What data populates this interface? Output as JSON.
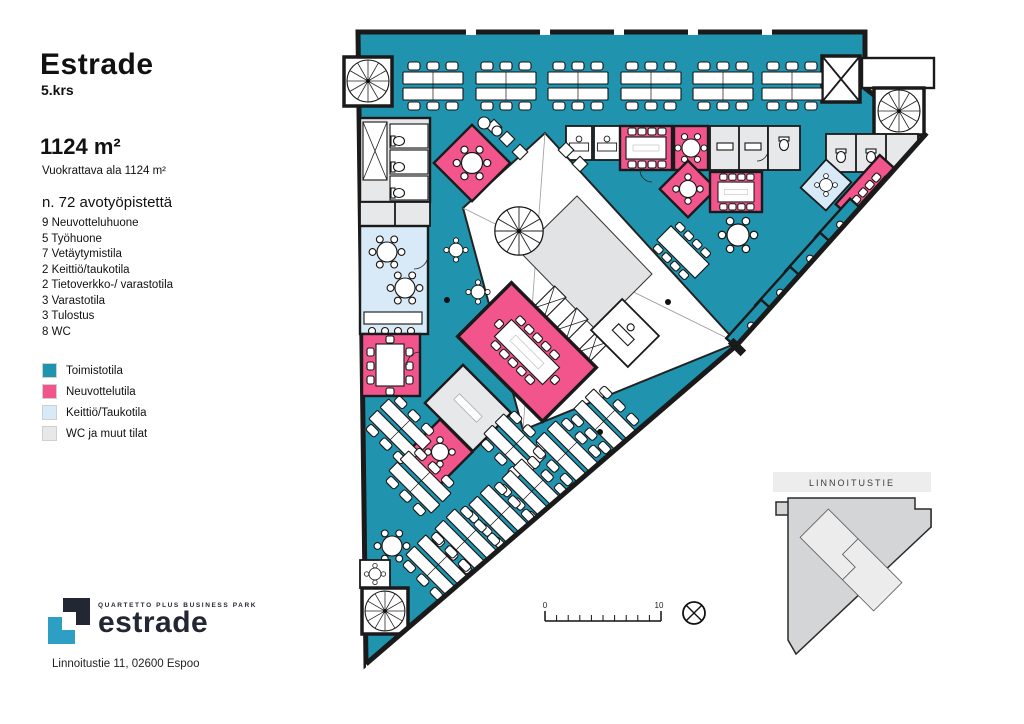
{
  "panel": {
    "title": "Estrade",
    "floor": "5.krs",
    "area_headline": "1124 m²",
    "area_subtitle": "Vuokrattava ala 1124 m²",
    "workpoints": "n. 72 avotyöpistettä",
    "room_counts": [
      "9 Neuvotteluhuone",
      "5 Työhuone",
      "7 Vetäytymistila",
      "2 Keittiö/taukotila",
      "2 Tietoverkko-/ varastotila",
      "3 Varastotila",
      "3 Tulostus",
      "8 WC"
    ]
  },
  "legend": {
    "items": [
      {
        "label": "Toimistotila",
        "color": "#2093AE"
      },
      {
        "label": "Neuvottelutila",
        "color": "#F2548C"
      },
      {
        "label": "Keittiö/Taukotila",
        "color": "#D8E9F7"
      },
      {
        "label": "WC ja muut tilat",
        "color": "#E7E8E9"
      }
    ]
  },
  "logo": {
    "park": "QUARTETTO PLUS BUSINESS PARK",
    "brand": "estrade",
    "address": "Linnoitustie 11, 02600 Espoo"
  },
  "minimap": {
    "street": "LINNOITUSTIE"
  },
  "scalebar": {
    "start": "0",
    "end": "10"
  },
  "colors": {
    "office": "#2093AE",
    "meeting": "#F2548C",
    "kitchen": "#D8E9F7",
    "wc": "#E7E8E9",
    "lobby": "#E2E3E4",
    "wall": "#1A1A1A",
    "minimap_fill": "#D4D5D6",
    "minimap_band": "#EDEDEE",
    "logo_navy": "#232734",
    "logo_blue": "#2E9FC4"
  }
}
